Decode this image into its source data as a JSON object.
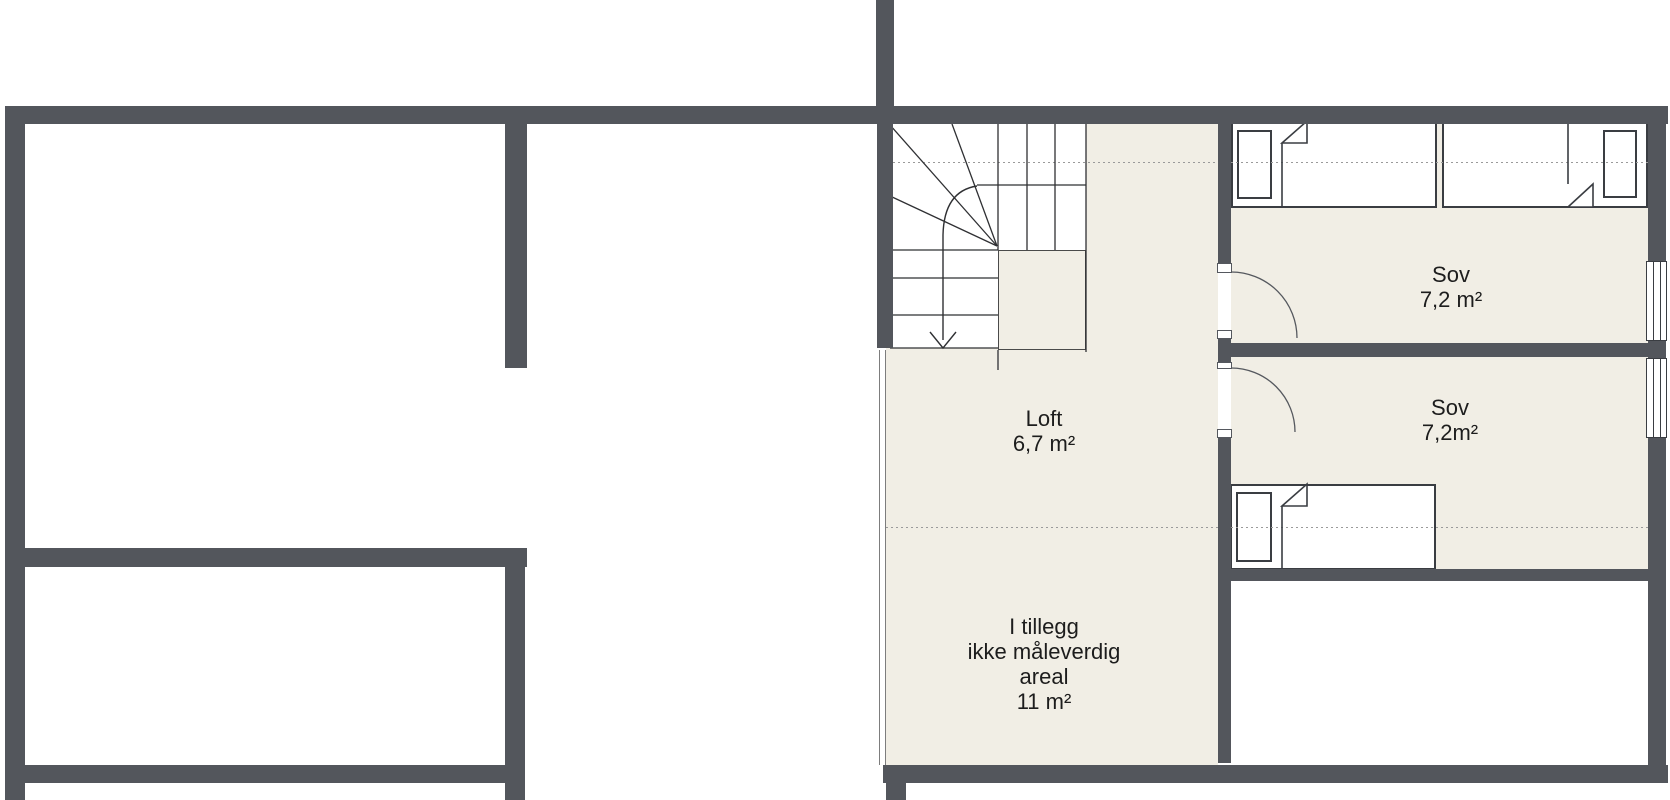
{
  "plan": {
    "type": "floor-plan",
    "rooms": {
      "loft": {
        "name": "Loft",
        "area": "6,7 m²"
      },
      "sov_top": {
        "name": "Sov",
        "area": "7,2 m²"
      },
      "sov_bottom": {
        "name": "Sov",
        "area": "7,2m²"
      },
      "extra_area": {
        "line1": "I tillegg",
        "line2": "ikke måleverdig",
        "line3": "areal",
        "line4": "11 m²"
      }
    },
    "colors": {
      "wall": "#53565c",
      "floor": "#f1eee5",
      "furniture_line": "#3a3d42",
      "stair_line": "#2f3033",
      "dashed_line": "#9a9a9a",
      "boundary_line": "#7d7d7d",
      "text": "#1d1d1d"
    }
  }
}
